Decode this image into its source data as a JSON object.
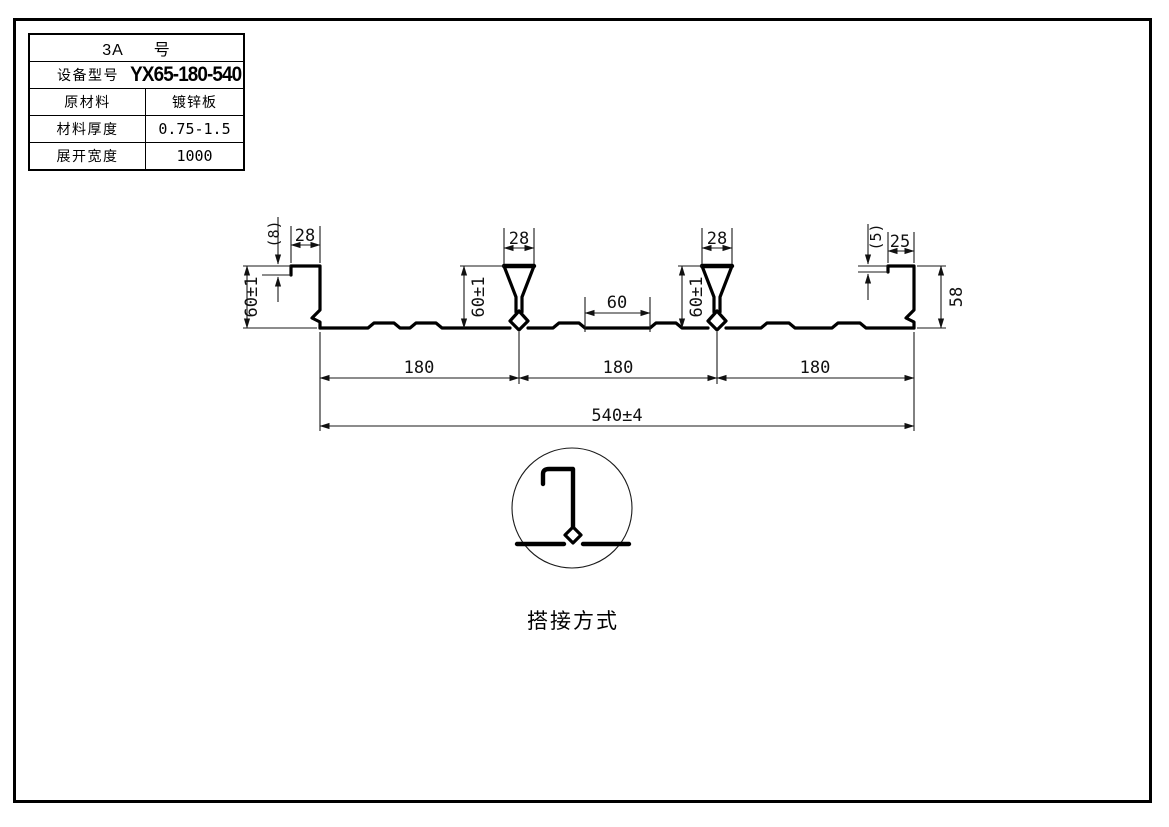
{
  "page": {
    "background": "#ffffff",
    "line_color": "#000000"
  },
  "spec_table": {
    "title": "3A  号",
    "rows": [
      {
        "label": "设备型号",
        "value": "YX65-180-540"
      },
      {
        "label": "原材料",
        "value": "镀锌板"
      },
      {
        "label": "材料厚度",
        "value": "0.75-1.5"
      },
      {
        "label": "展开宽度",
        "value": "1000"
      }
    ]
  },
  "dims": {
    "left_lip": "(8)",
    "left_flange": "28",
    "left_height": "60±1",
    "rib1_top": "28",
    "rib1_height": "60±1",
    "mid_gap": "60",
    "rib2_top": "28",
    "rib2_height": "60±1",
    "right_lip": "(5)",
    "right_flange": "25",
    "right_height": "58",
    "pitch_1": "180",
    "pitch_2": "180",
    "pitch_3": "180",
    "overall_width": "540±4"
  },
  "detail": {
    "label": "搭接方式"
  }
}
